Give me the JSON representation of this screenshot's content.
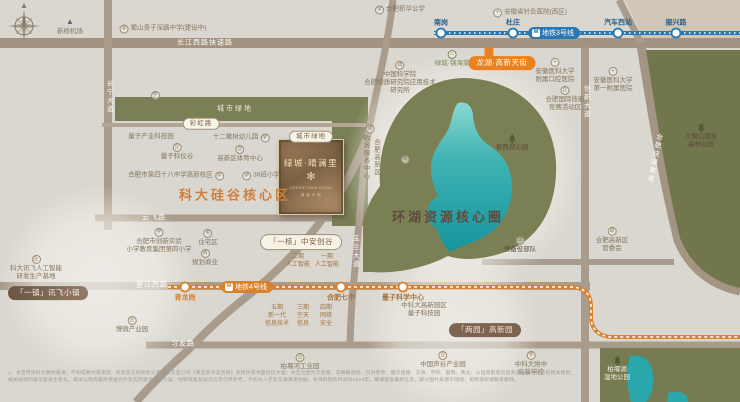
{
  "colors": {
    "bg": "#d9d7d0",
    "road": "#a99c8d",
    "green": "#767b52",
    "lake_top": "#86d4cd",
    "lake": "#1b9aa2",
    "metro3": "#2878b3",
    "metro4": "#d9822e",
    "accent_orange": "#cf7f3e",
    "dark_brown": "#5d4c3c",
    "poi_text": "#86765f",
    "card_gold": "#e9d9a8"
  },
  "project_card": {
    "green_pill": "城市绿地",
    "name": "绿城·晴澜里",
    "logo_glyph": "✻",
    "sub1": "GREENTOWN CHINA",
    "sub2": "绿 城 中 国"
  },
  "metro": {
    "line3": {
      "badge": "地铁3号线",
      "color": "#2878b3",
      "badge_x": 554,
      "badge_y": 33,
      "y": 33,
      "x1": 434,
      "x2": 740,
      "label_color": "#2d5f88",
      "stations": [
        {
          "label": "南岗",
          "x": 441
        },
        {
          "label": "杜庄",
          "x": 513
        },
        {
          "label": "汽车西站",
          "x": 618
        },
        {
          "label": "振兴路",
          "x": 676
        }
      ]
    },
    "line4": {
      "badge": "地铁4号线",
      "color": "#d9822e",
      "badge_x": 247,
      "badge_y": 287,
      "path": "M168,287 H570 C584,287 591,294 591,307 V317 C591,330 600,337 613,337 H740",
      "stations": [
        {
          "label": "青龙岗",
          "x": 185,
          "y": 287,
          "c": "#d9822e"
        },
        {
          "label": "合肥七中",
          "x": 341,
          "y": 287,
          "c": "#a5743f"
        },
        {
          "label": "量子科学中心",
          "x": 403,
          "y": 287,
          "c": "#a5743f"
        }
      ]
    }
  },
  "items": [
    {
      "n": "road-label-changjiangxilu",
      "t": "road",
      "x": 205,
      "y": 43,
      "lines": [
        "长江西路快速路"
      ]
    },
    {
      "n": "road-label-yunfeilu",
      "t": "road",
      "x": 154,
      "y": 218,
      "lines": [
        "云飞路"
      ]
    },
    {
      "n": "road-label-wangjiangxilu",
      "t": "road",
      "x": 152,
      "y": 285,
      "lines": [
        "望江西路"
      ]
    },
    {
      "n": "road-label-xiyoulu",
      "t": "road",
      "x": 183,
      "y": 344,
      "lines": [
        "习友路"
      ]
    },
    {
      "n": "road-pill-caihonglu",
      "t": "pill",
      "x": 201,
      "y": 124,
      "lines": [
        "彩虹路"
      ]
    },
    {
      "n": "road-vlabel-changningdadao",
      "t": "vroad",
      "x": 108,
      "y": 97,
      "lines": [
        "长宁大道"
      ]
    },
    {
      "n": "road-vlabel-yulandadao",
      "t": "vroad",
      "x": 354,
      "y": 252,
      "lines": [
        "玉兰大道"
      ]
    },
    {
      "n": "road-vlabel-chuangxindadao",
      "t": "vroad",
      "x": 585,
      "y": 102,
      "lines": [
        "创新大道"
      ]
    },
    {
      "n": "road-vlabel-raochenggaosu",
      "t": "vroad",
      "x": 653,
      "y": 158,
      "rot": 12,
      "lines": [
        "合肥绕城高速"
      ]
    },
    {
      "n": "green-label-chengshilvdi",
      "t": "glabel",
      "x": 235,
      "y": 109,
      "lines": [
        "城市绿地"
      ]
    },
    {
      "n": "poi-xinqiao-airport",
      "t": "poi",
      "x": 70,
      "y": 27,
      "icon": "plane",
      "ipos": "top",
      "lines": [
        "新桥机场"
      ]
    },
    {
      "n": "poi-guizishenlu-school",
      "t": "poi",
      "x": 163,
      "y": 29,
      "icon": "school",
      "ipos": "left",
      "lines": [
        "蜀山贵子深路中学(建设中)"
      ]
    },
    {
      "n": "poi-xinhua-gongxue",
      "t": "poi",
      "x": 400,
      "y": 10,
      "icon": "school",
      "ipos": "left",
      "lines": [
        "合肥新华公学"
      ]
    },
    {
      "n": "poi-zhenjiu-hospital",
      "t": "poi",
      "x": 530,
      "y": 13,
      "icon": "med",
      "ipos": "left",
      "lines": [
        "安徽省针灸医院(西区)"
      ]
    },
    {
      "n": "poi-xingzhi-school",
      "t": "poi",
      "x": 155,
      "y": 100,
      "icon": "school",
      "ipos": "top",
      "lines": [
        "合肥蜀山行知学校"
      ]
    },
    {
      "n": "poi-liangzi-industry-park",
      "t": "poi",
      "x": 151,
      "y": 137,
      "lines": [
        "量子产业科技园"
      ]
    },
    {
      "n": "poi-twelve-oaks-kindergarten",
      "t": "poi",
      "x": 241,
      "y": 138,
      "icon": "school",
      "ipos": "right",
      "lines": [
        "十二橡树幼儿园"
      ]
    },
    {
      "n": "poi-liangzi-keyigu",
      "t": "poi",
      "x": 177,
      "y": 152,
      "icon": "biz",
      "ipos": "top",
      "lines": [
        "量子科仪谷"
      ]
    },
    {
      "n": "poi-gaoxin-sports-center",
      "t": "poi",
      "x": 240,
      "y": 154,
      "icon": "biz",
      "ipos": "top",
      "lines": [
        "高新区体育中心"
      ]
    },
    {
      "n": "poi-no48-middle-school",
      "t": "poi",
      "x": 176,
      "y": 176,
      "icon": "school",
      "ipos": "right",
      "lines": [
        "合肥市第四十八中学高新校区"
      ]
    },
    {
      "n": "poi-36class-primary",
      "t": "poi",
      "x": 261,
      "y": 176,
      "icon": "school",
      "ipos": "left",
      "lines": [
        "36班小学"
      ]
    },
    {
      "n": "poi-lvcheng-jinhaitang",
      "t": "poi",
      "x": 452,
      "y": 59,
      "c": "#7d8c52",
      "icon": "house",
      "ipos": "top",
      "lines": [
        "绿城·锦海棠"
      ]
    },
    {
      "n": "poi-cas-institute",
      "t": "poi",
      "x": 400,
      "y": 78,
      "icon": "gov",
      "ipos": "top",
      "lines": [
        "中国科学院",
        "合肥物质研究院应用技术",
        "研究所"
      ]
    },
    {
      "n": "poi-kouqiang-hospital",
      "t": "poi",
      "x": 555,
      "y": 71,
      "icon": "med",
      "ipos": "top",
      "lines": [
        "安徽医科大学",
        "附属口腔医院"
      ]
    },
    {
      "n": "poi-jineng-zone",
      "t": "poi",
      "x": 565,
      "y": 99,
      "icon": "biz",
      "ipos": "top",
      "lines": [
        "合肥国际技能",
        "竞赛活动区"
      ]
    },
    {
      "n": "poi-anyi-first-hospital",
      "t": "poi",
      "x": 613,
      "y": 80,
      "icon": "med",
      "ipos": "top",
      "lines": [
        "安徽医科大学",
        "第一附属医院"
      ]
    },
    {
      "n": "poi-shuxihu-park",
      "t": "poi",
      "x": 512,
      "y": 143,
      "c": "#5d4c3c",
      "icon": "tree",
      "ipos": "top",
      "lines": [
        "蜀西湖公园"
      ]
    },
    {
      "n": "poi-dashushan-forest",
      "t": "poi",
      "x": 701,
      "y": 136,
      "c": "#5d4c3c",
      "icon": "tree",
      "ipos": "top",
      "lines": [
        "大蜀山国家",
        "森林公园"
      ]
    },
    {
      "n": "poi-shazhichuan-outlets",
      "t": "poi",
      "x": 405,
      "y": 164,
      "icon": "shop",
      "ipos": "top",
      "lines": [
        "砂之船奥莱"
      ]
    },
    {
      "n": "poi-zhengwu-center",
      "t": "vpoi",
      "x": 370,
      "y": 152,
      "icon": "gov",
      "cols": [
        "合肥高新区",
        "政务服务中心"
      ]
    },
    {
      "n": "poi-yubeiyi",
      "t": "poi",
      "x": 520,
      "y": 245,
      "c": "#5d4c3c",
      "icon": "gov",
      "ipos": "top",
      "lines": [
        "预备役部队"
      ]
    },
    {
      "n": "poi-gaoxin-guanweihui",
      "t": "poi",
      "x": 612,
      "y": 240,
      "icon": "gov",
      "ipos": "top",
      "lines": [
        "合肥高新区",
        "管委会"
      ]
    },
    {
      "n": "poi-iflytek-base",
      "t": "poi",
      "x": 36,
      "y": 268,
      "icon": "biz",
      "ipos": "top",
      "lines": [
        "科大讯飞人工智能",
        "研发生产基地"
      ]
    },
    {
      "n": "poi-chuangxin-primary",
      "t": "poi",
      "x": 159,
      "y": 241,
      "icon": "school",
      "ipos": "top",
      "lines": [
        "合肥市创新实验",
        "小学教育集团第四小学"
      ]
    },
    {
      "n": "poi-zhuzhaiqu",
      "t": "poi",
      "x": 208,
      "y": 238,
      "icon": "home",
      "ipos": "top",
      "lines": [
        "住宅区"
      ]
    },
    {
      "n": "poi-guihua-shangye",
      "t": "poi",
      "x": 205,
      "y": 258,
      "icon": "shop",
      "ipos": "top",
      "lines": [
        "规划商业"
      ]
    },
    {
      "n": "poi-bowei-industry",
      "t": "poi",
      "x": 132,
      "y": 325,
      "icon": "biz",
      "ipos": "top",
      "lines": [
        "博微产业园"
      ]
    },
    {
      "n": "poi-shenggu-industry",
      "t": "poi",
      "x": 443,
      "y": 360,
      "icon": "biz",
      "ipos": "top",
      "lines": [
        "中国声谷产业园"
      ]
    },
    {
      "n": "poi-zhongkeda-fuzhong",
      "t": "poi",
      "x": 531,
      "y": 364,
      "icon": "school",
      "ipos": "top",
      "lines": [
        "中科大附中",
        "高新学校"
      ]
    },
    {
      "n": "poi-zhongkeda-liangzi",
      "t": "poi",
      "x": 424,
      "y": 310,
      "lines": [
        "中科大高新园区",
        "量子科技园"
      ]
    },
    {
      "n": "poi-baiyanhu-wetland",
      "t": "poi",
      "x": 617,
      "y": 369,
      "c": "#f0ede4",
      "icon": "tree",
      "ipos": "top",
      "lines": [
        "柏堰湖",
        "湿地公园"
      ]
    },
    {
      "n": "poi-baiyan-industrial",
      "t": "poi",
      "x": 300,
      "y": 362,
      "icon": "biz",
      "ipos": "top",
      "lines": [
        "柏堰河工业园"
      ]
    },
    {
      "n": "icon-longhu-tianjie",
      "t": "sq",
      "x": 489,
      "y": 52
    },
    {
      "n": "badge-longhu-tianjie",
      "t": "badge",
      "x": 502,
      "y": 63,
      "bg": "#e8821e",
      "c": "#fff",
      "lines": [
        "龙湖·高新天街"
      ]
    },
    {
      "n": "badge-yizhen-xunfei",
      "t": "badge",
      "x": 48,
      "y": 293,
      "bg": "linear-gradient(90deg,#6b5544,#93796a)",
      "c": "#f5efe5",
      "lines": [
        "「一镇」讯飞小镇"
      ]
    },
    {
      "n": "badge-yihe-zhongan",
      "t": "badge",
      "x": 301,
      "y": 242,
      "bg": "#f7f2e6",
      "c": "#7c5f45",
      "border": "#a08f77",
      "lines": [
        "「一核」中安创谷"
      ]
    },
    {
      "n": "badge-liangyuan-gaoxin",
      "t": "badge",
      "x": 485,
      "y": 330,
      "bg": "#7d6450",
      "c": "#f0e8d8",
      "lines": [
        "「两园」高新园"
      ]
    },
    {
      "n": "label-phase2-ai",
      "t": "plabel",
      "x": 298,
      "y": 261,
      "lines": [
        "二期",
        "人工智能"
      ]
    },
    {
      "n": "label-phase1-ai",
      "t": "plabel",
      "x": 327,
      "y": 261,
      "lines": [
        "一期",
        "人工智能"
      ]
    },
    {
      "n": "label-phase5-it",
      "t": "plabel",
      "x": 277,
      "y": 316,
      "lines": [
        "五期",
        "新一代",
        "信息技术"
      ]
    },
    {
      "n": "label-phase3-aerospace",
      "t": "plabel",
      "x": 303,
      "y": 316,
      "lines": [
        "三期",
        "空天",
        "信息"
      ]
    },
    {
      "n": "label-phase4-security",
      "t": "plabel",
      "x": 326,
      "y": 316,
      "lines": [
        "四期",
        "网络",
        "安全"
      ]
    },
    {
      "n": "pill-chengshilvdi-card",
      "t": "pill",
      "x": 311,
      "y": 137,
      "lines": [
        "城市绿地"
      ]
    },
    {
      "n": "area-label-kedaguigu",
      "t": "area",
      "x": 235,
      "y": 196,
      "c": "#cf7f3e",
      "lines": [
        "科大硅谷核心区"
      ]
    },
    {
      "n": "area-label-huanhu",
      "t": "area",
      "x": 448,
      "y": 218,
      "c": "#5d4c3c",
      "lines": [
        "环湖资源核心圈"
      ]
    },
    {
      "n": "disclaimer-line1",
      "t": "disc",
      "x": 8,
      "y": 374,
      "a": "l",
      "lines": [
        "1、本宣传资料为要约邀请，不构成要约或承诺，买卖双方的权利义务以双方签订的《商品房买卖合同》及附件等书面协议为准；本区位图为示意图，非精确测绘，仅供参考；图示道路、交通、学校、医院、商业、公园等配套信息来源于政府公示的相关规划；"
      ]
    },
    {
      "n": "disclaimer-line2",
      "t": "disc",
      "x": 8,
      "y": 381,
      "a": "l",
      "lines": [
        "相关规划内容可能发生变化，具体以政府最终批准文件及实际建设交付为准；地铁线路及站点信息仅供参考，不作为入学及交通承诺依据；本资料制作时间为2023年，敬请留意最新信息。部分图片来源于网络，如有侵权请联系删除。"
      ]
    }
  ]
}
